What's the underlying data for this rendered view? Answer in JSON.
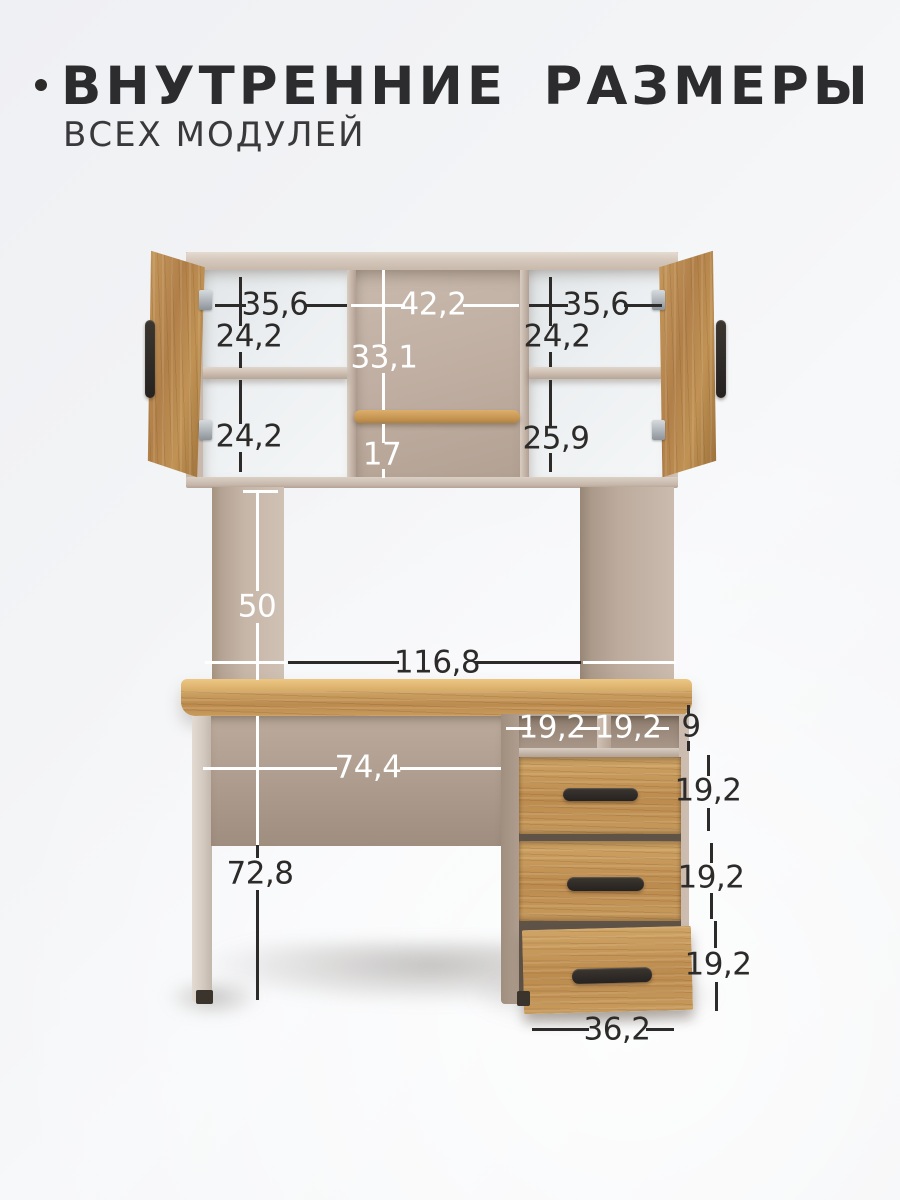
{
  "page": {
    "title_bullet": "•",
    "title": "ВНУТРЕННИЕ РАЗМЕРЫ",
    "subtitle": "ВСЕХ МОДУЛЕЙ"
  },
  "colors": {
    "background": "#f2f3f5",
    "text_dark": "#2c2b29",
    "text_white": "#ffffff",
    "beige_panel": "#c4b4a7",
    "beige_dark": "#a09080",
    "cabinet_interior_white": "#edf0f2",
    "wood_light": "#cfa465",
    "wood_dark": "#a87c42",
    "handle_dark": "#2d2925"
  },
  "diagram": {
    "hutch": {
      "left_cabinet": {
        "inner_width": "35,6",
        "upper_height": "24,2",
        "lower_height": "24,2"
      },
      "center_niche": {
        "inner_width": "42,2",
        "upper_height": "33,1",
        "lower_height": "17"
      },
      "right_cabinet": {
        "inner_width": "35,6",
        "upper_height": "24,2",
        "lower_height": "25,9"
      }
    },
    "under_hutch": {
      "opening_height": "50",
      "opening_width": "116,8"
    },
    "desk": {
      "knee_space_width": "74,4",
      "desk_height": "72,8"
    },
    "pedestal": {
      "niche_left_width": "19,2",
      "niche_right_width": "19,2",
      "niche_height": "9",
      "drawers": [
        "19,2",
        "19,2",
        "19,2"
      ],
      "outer_width": "36,2"
    }
  }
}
